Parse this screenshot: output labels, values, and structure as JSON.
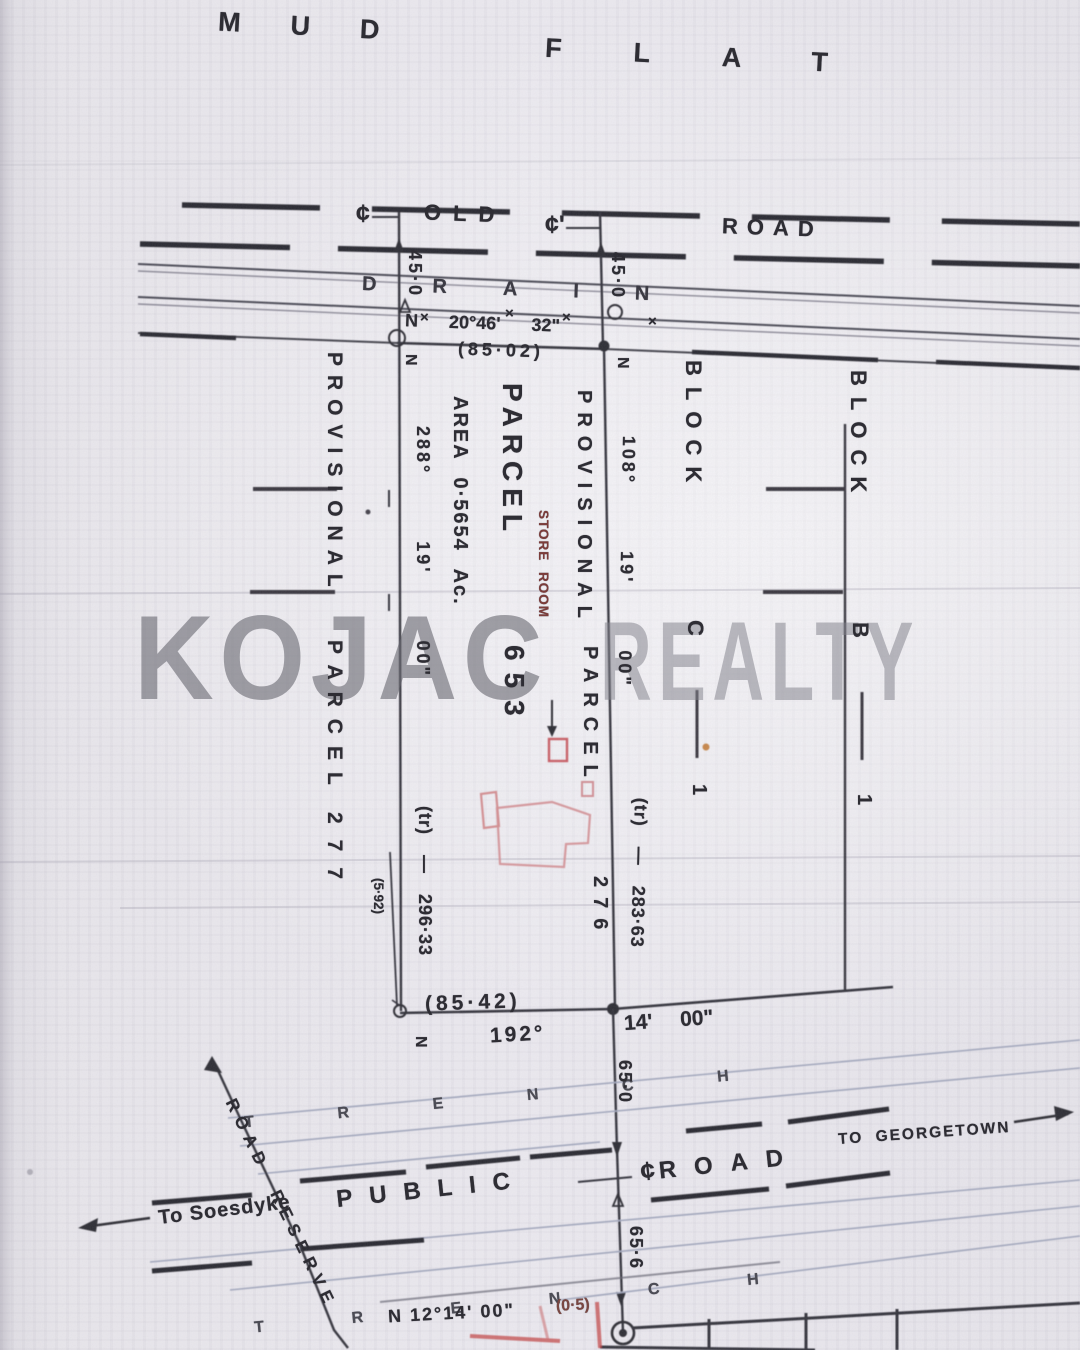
{
  "region_top": {
    "mud": "MUD",
    "flat": "FLAT",
    "old": "OLD",
    "road": "ROAD",
    "drain": "DRAIN"
  },
  "symbols": {
    "centerline": "¢",
    "centerline_prime": "¢'",
    "cross": "×",
    "station": "N"
  },
  "dims_top": {
    "west_45": "45·0",
    "east_45": "45·0",
    "bearing": "N 20°46' 32\"",
    "distance": "(85·02)"
  },
  "parcel_277": {
    "provisional": "PROVISIONAL",
    "parcel": "PARCEL",
    "number": "277"
  },
  "west_line": {
    "bearing": "288° 19' 00\"",
    "distance": "(tr) — 296·33",
    "offset": "(5·92)"
  },
  "parcel_653": {
    "area": "AREA 0·5654 Ac.",
    "parcel": "PARCEL",
    "number": "653",
    "store_room": "STORE ROOM"
  },
  "parcel_276": {
    "provisional": "PROVISIONAL",
    "parcel": "PARCEL",
    "number": "276"
  },
  "east_line": {
    "bearing": "108° 19' 00\"",
    "distance": "(tr) — 283·63"
  },
  "block_c": {
    "block": "BLOCK",
    "letter": "C",
    "number": "1"
  },
  "block_b": {
    "block": "BLOCK",
    "letter": "B",
    "number": "1"
  },
  "south_line": {
    "distance": "(85·42)",
    "bearing_deg": "192°",
    "bearing_min": "14' 00\"",
    "south_bearing": "N 12°14' 00\"",
    "offset_note": "(0·5)"
  },
  "trench": {
    "word": "TRENCH"
  },
  "road_bottom": {
    "public": "PUBLIC",
    "road": "ROAD",
    "to_georgetown": "TO GEORGETOWN",
    "to_soesdyke": "To Soesdyke",
    "road_reserve": "ROAD RESERVE",
    "dim_65_0": "65·0",
    "dim_65_6": "65·6"
  },
  "watermark": {
    "word1": "KOJAC",
    "word2": "REALTY"
  },
  "colors": {
    "ink": "#2e2d34",
    "red_pen": "#c44a4a",
    "building_red": "#d49093",
    "watermark_gray": "#8a8a92"
  }
}
